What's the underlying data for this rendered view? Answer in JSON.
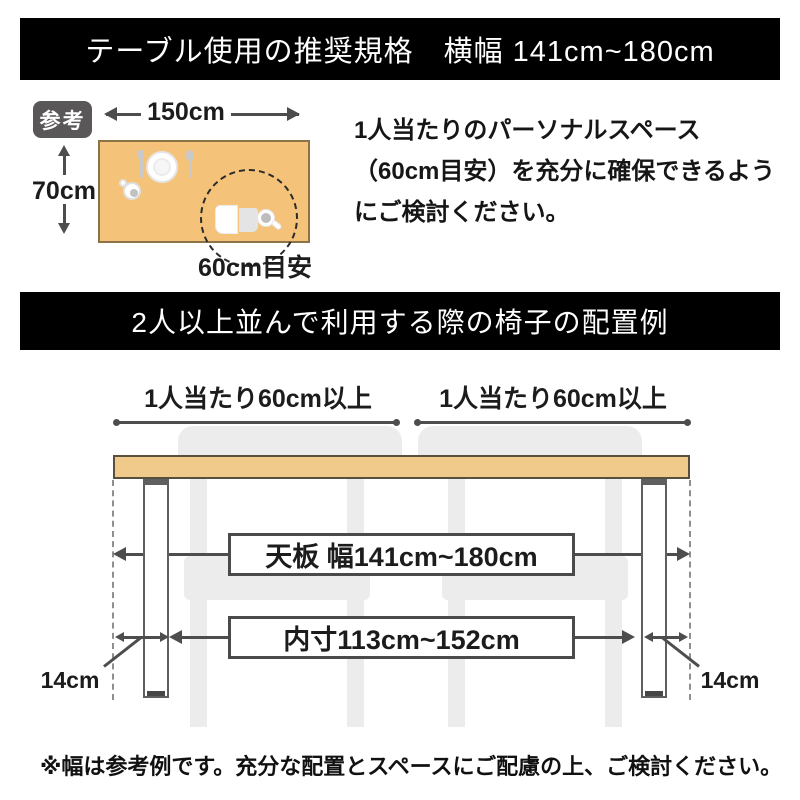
{
  "header": {
    "title": "テーブル使用の推奨規格　横幅 141cm~180cm"
  },
  "reference": {
    "badge_label": "参考",
    "width_label": "150cm",
    "depth_label": "70cm",
    "personal_space_label": "60cm目安",
    "description": "1人当たりのパーソナルスペース（60cm目安）を充分に確保できるようにご検討ください。"
  },
  "arrangement": {
    "title": "2人以上並んで利用する際の椅子の配置例",
    "per_person_left": "1人当たり60cm以上",
    "per_person_right": "1人当たり60cm以上",
    "tabletop_width": "天板 幅141cm~180cm",
    "inner_width": "内寸113cm~152cm",
    "leg_offset_left": "14cm",
    "leg_offset_right": "14cm"
  },
  "footnote": "※幅は参考例です。充分な配置とスペースにご配慮の上、ご検討ください。",
  "colors": {
    "banner_bg": "#000000",
    "banner_text": "#ffffff",
    "badge_bg": "#595757",
    "reference_table_fill": "#F4C379",
    "tabletop_fill": "#F0CA8A",
    "chair_fill": "#ECECEC",
    "dimension_line": "#4d4d4d"
  }
}
